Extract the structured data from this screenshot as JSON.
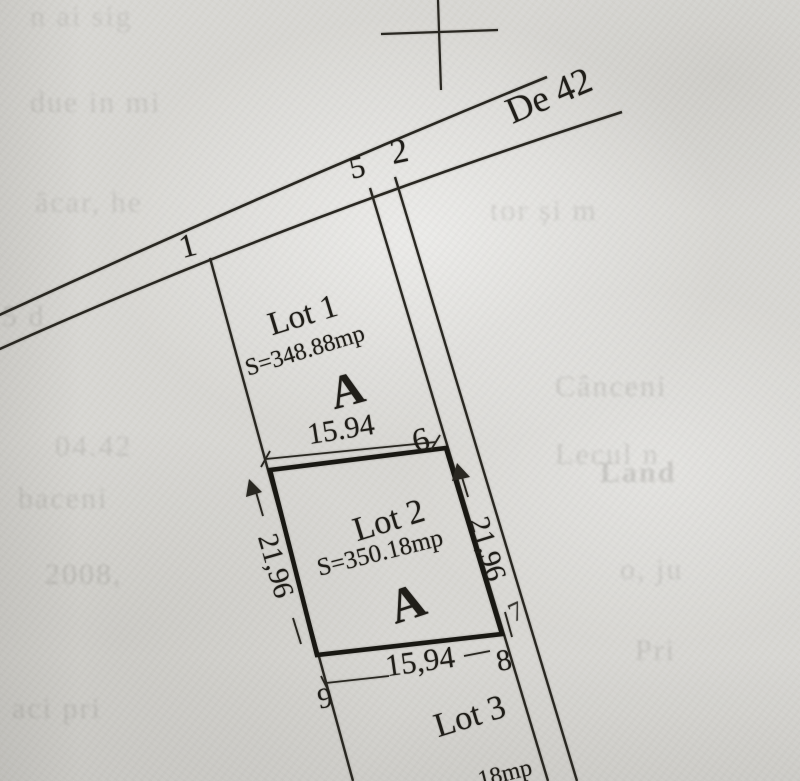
{
  "plan": {
    "road_label": "De 42",
    "lots": [
      {
        "name": "Lot 1",
        "area": "S=348.88mp",
        "zone_letter": "A"
      },
      {
        "name": "Lot 2",
        "area": "S=350.18mp",
        "zone_letter": "A"
      },
      {
        "name": "Lot 3",
        "area_visible_fragment": "18mp"
      }
    ],
    "dimensions": {
      "lot1_front_width": "15.94",
      "lot2_left_side": "21,96",
      "lot2_right_side": "21,96",
      "lot2_bottom_width": "15,94"
    },
    "survey_points": {
      "p1": "1",
      "p2": "2",
      "p5": "5",
      "p6": "6",
      "p7": "7",
      "p8": "8",
      "p9": "9"
    }
  },
  "colors": {
    "paper": "#d8d7d3",
    "ink": "#24221c"
  },
  "bleedthrough_fragments": [
    "n ai sig",
    "due in mi",
    "ăcar, he",
    "tor și m",
    "5 d",
    "Cânceni",
    "04.42",
    "Lecul n",
    "baceni",
    "Land",
    "2008,",
    "o, ju",
    "Pri",
    "aci pri"
  ]
}
